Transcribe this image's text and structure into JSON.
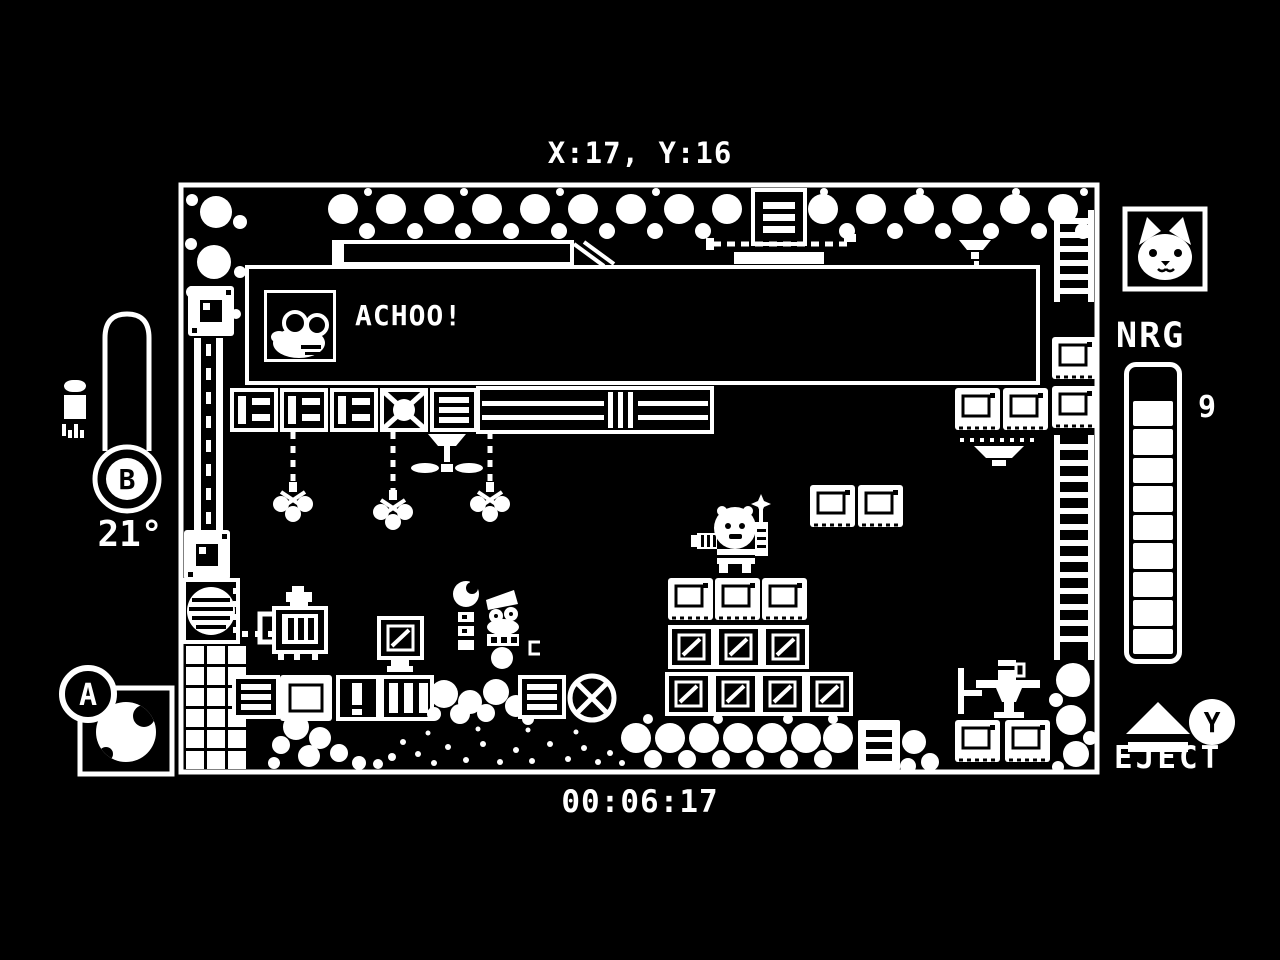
{
  "colors": {
    "background": "#000000",
    "foreground": "#ffffff"
  },
  "hud": {
    "position": "X:17, Y:16",
    "timer": "00:06:17",
    "buttons": {
      "a": "A",
      "b": "B",
      "y": "Y"
    },
    "thermometer": {
      "value": "21°",
      "icon": "spray-can-icon",
      "bound_button": "B"
    },
    "item_slot": {
      "item": "ball",
      "icon": "ball-icon",
      "bound_button": "A"
    },
    "energy": {
      "label": "NRG",
      "value": "9",
      "filled": 9,
      "total": 10,
      "portrait": "cat-face-icon"
    },
    "eject": {
      "label": "EJECT",
      "icon": "eject-icon",
      "bound_button": "Y"
    }
  },
  "dialog": {
    "speaker_portrait": "mole-with-glasses-icon",
    "text": "ACHOO!"
  },
  "game_field": {
    "player": "cat-astronaut-robot",
    "visible_entities": [
      "bubble-clusters",
      "conveyor-belt",
      "hanging-claw-hooks",
      "fan-drone",
      "panel-crates",
      "slash-crates",
      "crate-stack",
      "furnace-machine",
      "vent-grate",
      "magnet-tiles",
      "pipe-column",
      "ladders",
      "npc-robot",
      "wrench-pickup",
      "table-with-cup",
      "chair",
      "crossed-circle-tile"
    ]
  }
}
